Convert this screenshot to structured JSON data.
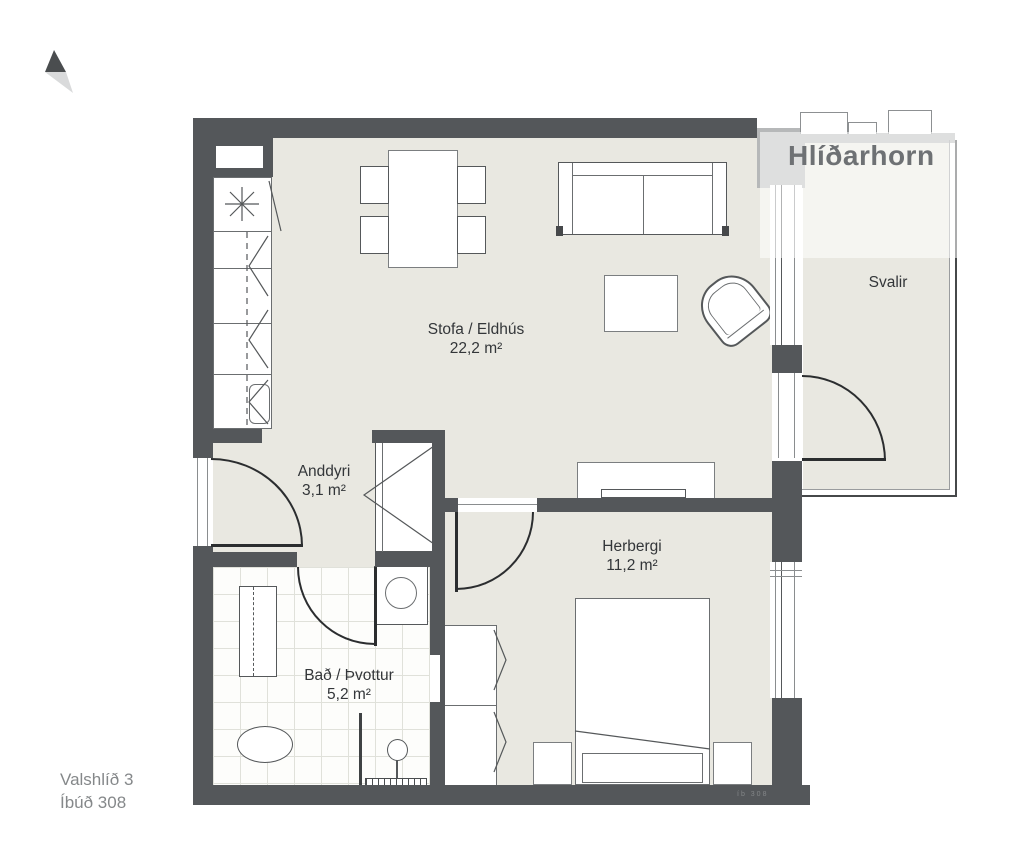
{
  "logo": {
    "text": "Hlíðarhorn"
  },
  "project": {
    "street": "Valshlíð 3",
    "unit": "Íbúð 308"
  },
  "rooms": {
    "living": {
      "name": "Stofa / Eldhús",
      "area": "22,2 m²"
    },
    "entry": {
      "name": "Anddyri",
      "area": "3,1 m²"
    },
    "bedroom": {
      "name": "Herbergi",
      "area": "11,2 m²"
    },
    "bath": {
      "name": "Bað / Þvottur",
      "area": "5,2 m²"
    },
    "balcony": {
      "name": "Svalir"
    }
  },
  "wall_stamp": "íb 308",
  "colors": {
    "wall": "#54575a",
    "exwall": "#b6b8b9",
    "floor": "#e9e8e1",
    "tile_line": "#e0e1da",
    "line": "#55585a",
    "door": "#2b2d2f",
    "label": "#333639",
    "muted": "#85888a",
    "logo": "#6e7174"
  }
}
